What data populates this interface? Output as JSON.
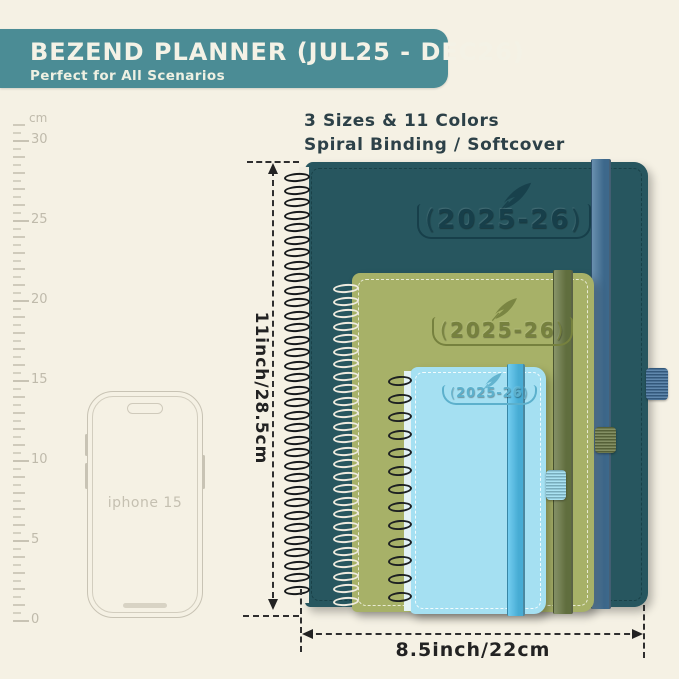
{
  "background_color": "#f5f1e4",
  "banner": {
    "title": "BEZEND PLANNER (JUL25 - DEC26)",
    "subtitle": "Perfect for All Scenarios",
    "bg_color": "#4b8c95",
    "text_color": "#f4f2e6"
  },
  "features": {
    "line1": "3 Sizes & 11 Colors",
    "line2": "Spiral Binding / Softcover",
    "text_color": "#2d4148"
  },
  "ruler": {
    "unit": "cm",
    "numbers": [
      "30",
      "25",
      "20",
      "15",
      "10",
      "5",
      "0"
    ],
    "tick_color": "#c8c3b4",
    "label_color": "#bfbaab"
  },
  "phone": {
    "label": "iphone 15",
    "outline_color": "#c8c3b4"
  },
  "decor": {
    "paren_open": "(",
    "paren_close": ")"
  },
  "planners": [
    {
      "name": "large",
      "year": "2025-26",
      "cover_color": "#27565f",
      "band_color": "#44749b",
      "loop_color": "#41719d",
      "coil_color": "#16191b",
      "emboss_color": "#173f4a"
    },
    {
      "name": "medium",
      "year": "2025-26",
      "cover_color": "#a7b168",
      "band_color": "#6b7a45",
      "loop_color": "#6d7b46",
      "coil_color": "#efebdf",
      "emboss_color": "#76813e"
    },
    {
      "name": "small",
      "year": "2025-26",
      "cover_color": "#a5e0f2",
      "band_color": "#4fc0ec",
      "loop_color": "#9adcf0",
      "coil_color": "#1d2022",
      "emboss_color": "#5cb0cc"
    }
  ],
  "dimensions": {
    "height_label": "11inch/28.5cm",
    "width_label": "8.5inch/22cm"
  }
}
